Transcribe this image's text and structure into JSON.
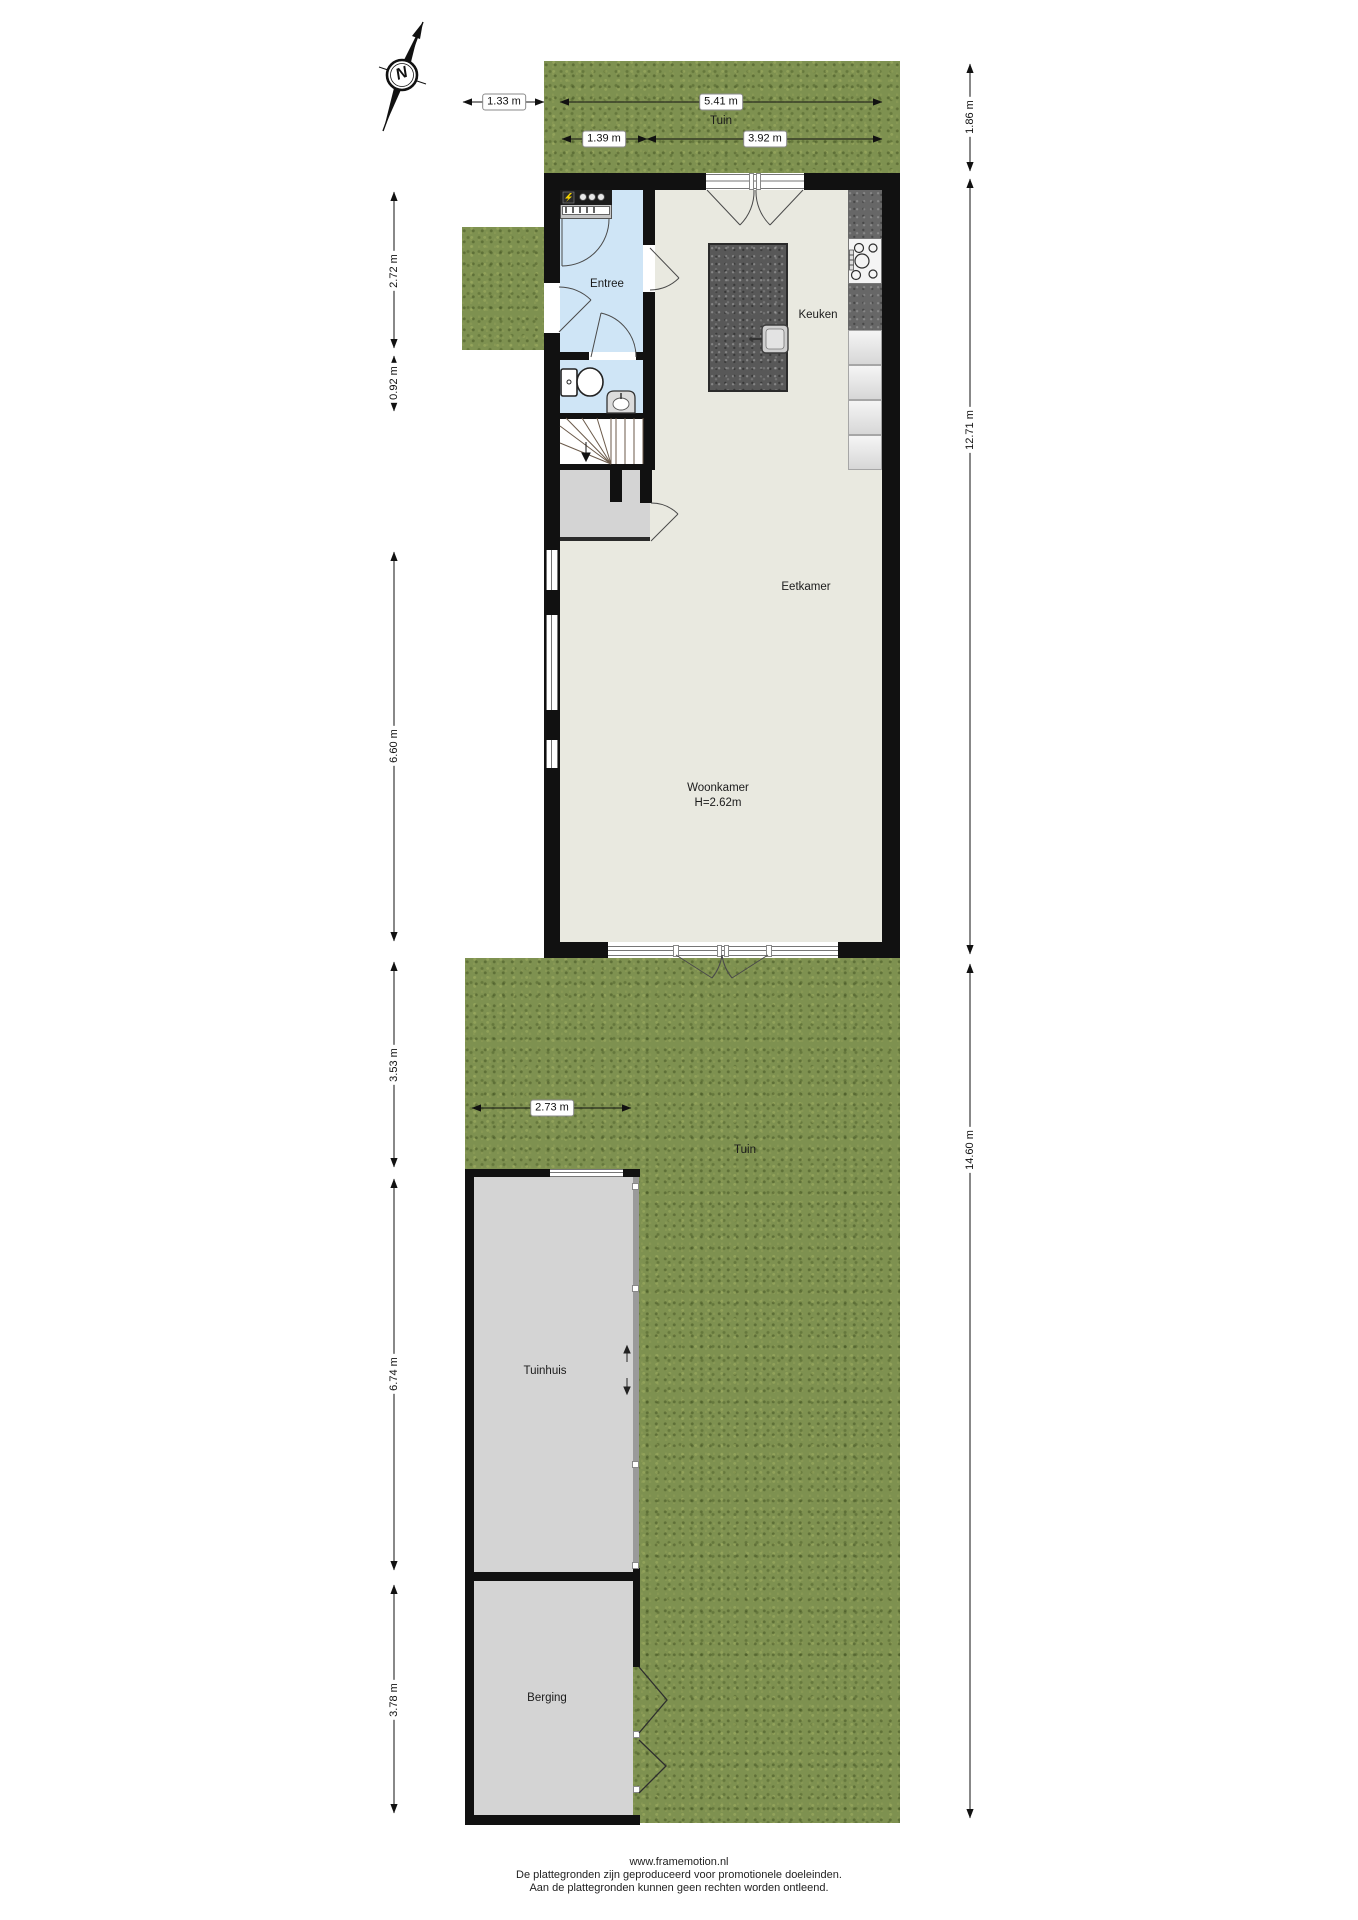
{
  "compass": {
    "north_label": "N"
  },
  "garden_top": {
    "label": "Tuin"
  },
  "garden_bottom": {
    "label": "Tuin"
  },
  "rooms": {
    "entree": "Entree",
    "keuken": "Keuken",
    "eetkamer": "Eetkamer",
    "woonkamer": "Woonkamer",
    "woonkamer_ceiling": "H=2.62m",
    "tuinhuis": "Tuinhuis",
    "berging": "Berging"
  },
  "dimensions": {
    "top_side": "1.33 m",
    "top_width_total": "5.41 m",
    "top_width_entree": "1.39 m",
    "top_width_main": "3.92 m",
    "right_garden_top": "1.86 m",
    "right_house": "12.71 m",
    "right_garden_bottom": "14.60 m",
    "left_entree": "2.72 m",
    "left_toilet": "0.92 m",
    "left_woonkamer": "6.60 m",
    "left_garden_strip": "3.53 m",
    "tuinhuis_width": "2.73 m",
    "left_tuinhuis": "6.74 m",
    "left_berging": "3.78 m"
  },
  "footer": {
    "website": "www.framemotion.nl",
    "disclaimer_line1": "De plattegronden zijn geproduceerd voor promotionele doeleinden.",
    "disclaimer_line2": "Aan de plattegronden kunnen geen rechten worden ontleend."
  },
  "colors": {
    "grass": "#7e9150",
    "wall": "#111111",
    "floor": "#e9e9e0",
    "entree_floor": "#cfe5f6",
    "outbuilding_floor": "#d4d4d4",
    "island": "#585858",
    "counter": "#676767",
    "meter_accent": "#f5d300"
  }
}
